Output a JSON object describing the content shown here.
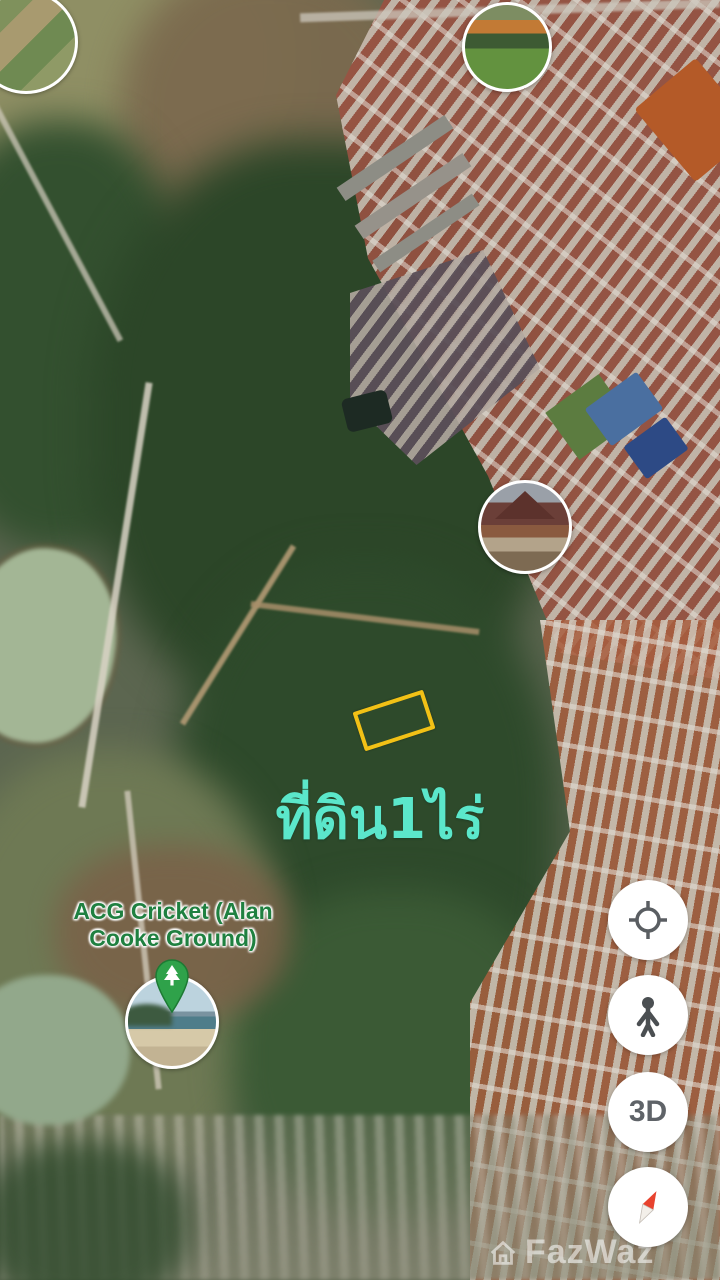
{
  "map": {
    "land_plot_label": "ที่ดิน1ไร่"
  },
  "poi": {
    "label_line1": "ACG Cricket (Alan",
    "label_line2": "Cooke Ground)",
    "marker_icon": "park-tree-pin-icon",
    "photo_thumbnails": [
      {
        "id": "top-left",
        "content": "aerial-land-photo"
      },
      {
        "id": "top-center",
        "content": "orange-roof-green-field-photo"
      },
      {
        "id": "temple",
        "content": "thai-temple-photo"
      },
      {
        "id": "beach",
        "content": "beach-bay-photo"
      }
    ]
  },
  "controls": {
    "my_location_icon": "my-location-target-icon",
    "street_view_icon": "pegman-icon",
    "three_d_button_label": "3D",
    "compass_icon": "compass-needle-icon"
  },
  "watermark": {
    "logo_icon": "house-logo-icon",
    "text": "FazWaz"
  },
  "colors": {
    "plot_outline": "#F2C116",
    "plot_label": "#5BE7CB",
    "poi_label": "#1F8040",
    "pin_green": "#2FA24A",
    "control_icon": "#5F6368",
    "compass_red": "#E8432E"
  }
}
